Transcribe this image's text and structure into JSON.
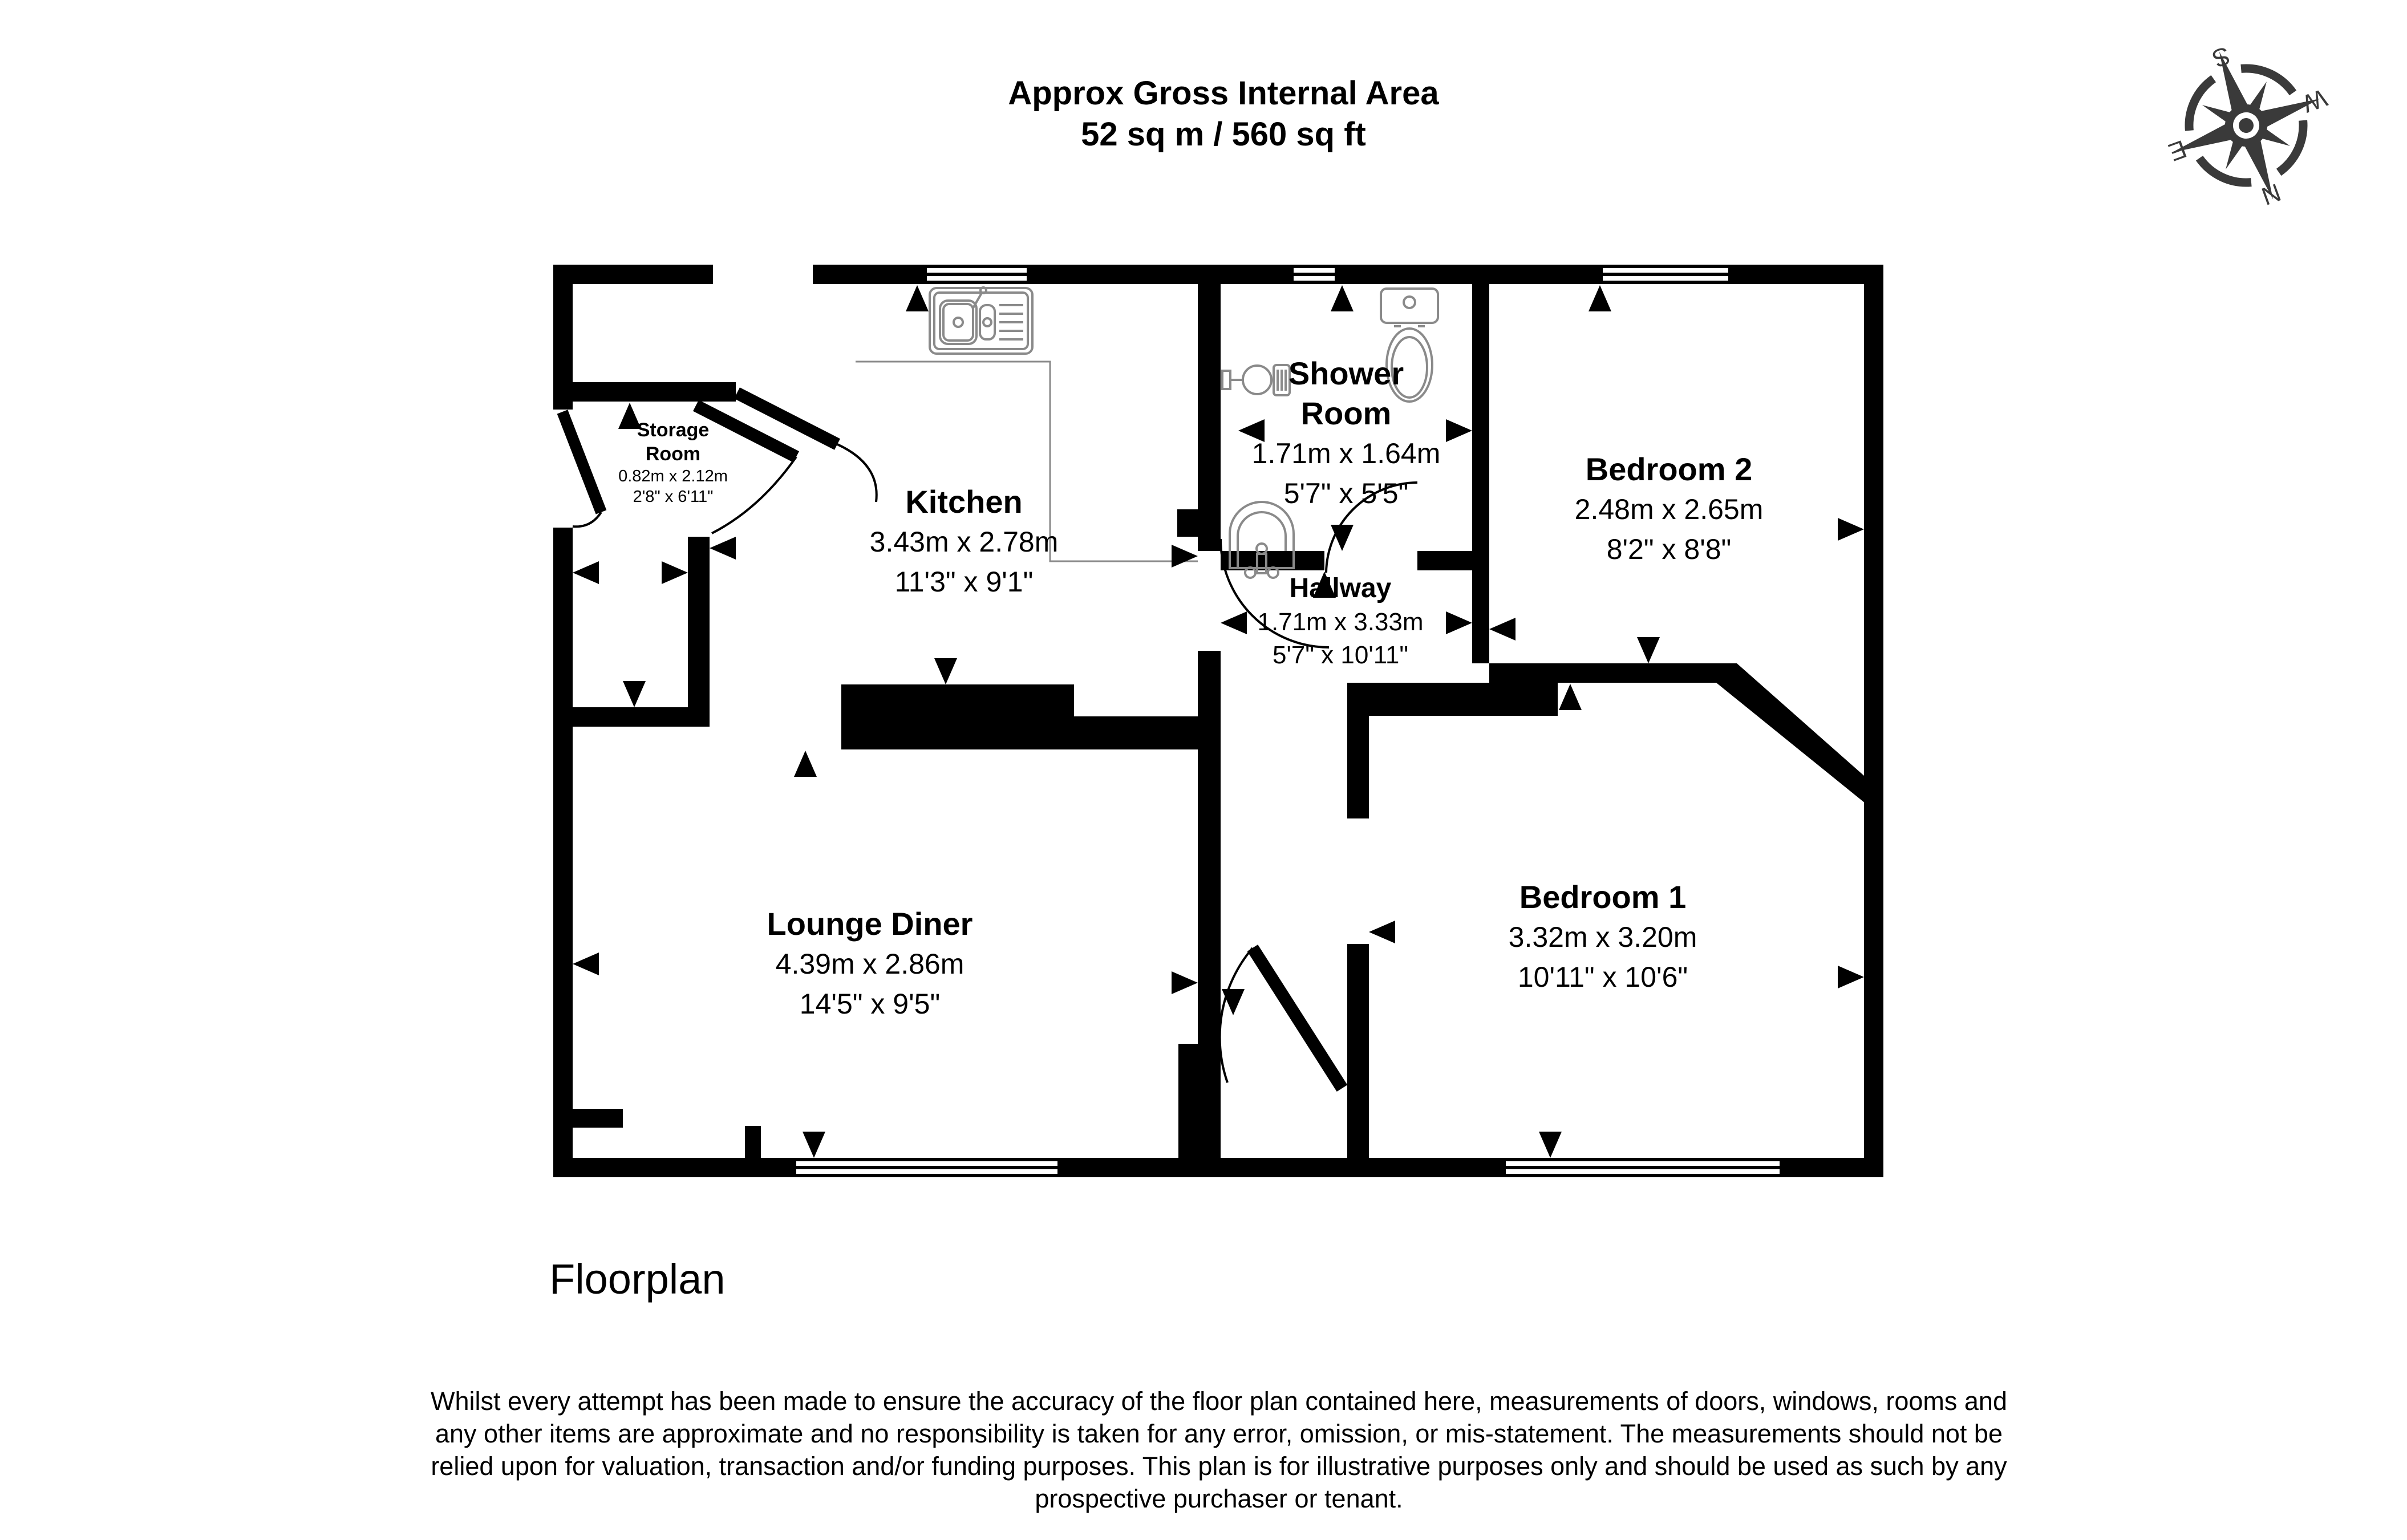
{
  "title": {
    "line1": "Approx Gross Internal Area",
    "line2": "52 sq m / 560 sq ft"
  },
  "compass": {
    "n": "N",
    "s": "S",
    "e": "E",
    "w": "W"
  },
  "rooms": [
    {
      "id": "storage-room",
      "name": "Storage Room",
      "metric": "0.82m x 2.12m",
      "imperial": "2'8\" x 6'11\""
    },
    {
      "id": "kitchen",
      "name": "Kitchen",
      "metric": "3.43m x 2.78m",
      "imperial": "11'3\" x 9'1\""
    },
    {
      "id": "shower-room",
      "name": "Shower Room",
      "metric": "1.71m x 1.64m",
      "imperial": "5'7\" x 5'5\""
    },
    {
      "id": "bedroom-2",
      "name": "Bedroom 2",
      "metric": "2.48m x 2.65m",
      "imperial": "8'2\" x 8'8\""
    },
    {
      "id": "hallway",
      "name": "Hallway",
      "metric": "1.71m x 3.33m",
      "imperial": "5'7\" x 10'11\""
    },
    {
      "id": "lounge-diner",
      "name": "Lounge Diner",
      "metric": "4.39m x 2.86m",
      "imperial": "14'5\" x 9'5\""
    },
    {
      "id": "bedroom-1",
      "name": "Bedroom 1",
      "metric": "3.32m x 3.20m",
      "imperial": "10'11\" x 10'6\""
    }
  ],
  "footer": {
    "label": "Floorplan",
    "disclaimer_lines": [
      "Whilst every attempt has been made to ensure the accuracy of the floor plan contained here, measurements of doors, windows, rooms and",
      "any other items are approximate and no responsibility is taken for any error, omission, or mis-statement. The measurements should not be",
      "relied upon for valuation, transaction and/or funding purposes. This plan is for illustrative purposes only and should be used as such by any",
      "prospective purchaser or tenant."
    ]
  },
  "colors": {
    "walls": "#000000",
    "fixtures": "#8a8a8a",
    "compass": "#3a3a3a"
  }
}
